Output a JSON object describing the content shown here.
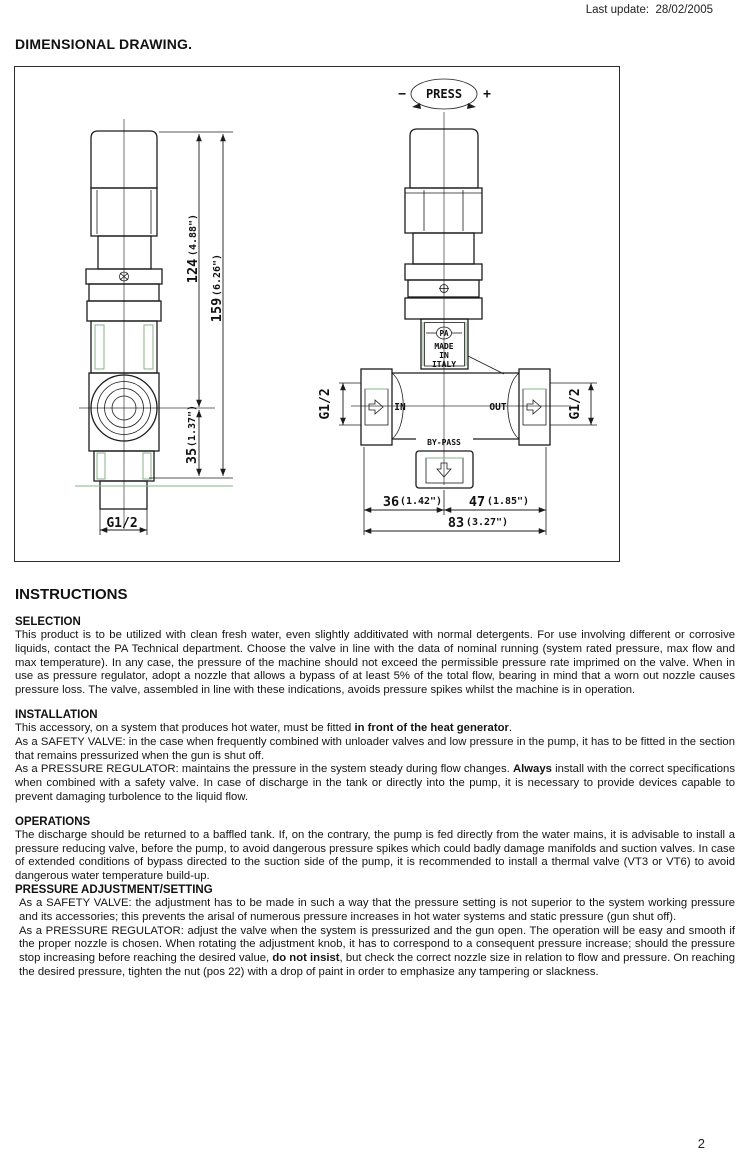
{
  "page": {
    "last_update_label": "Last update:",
    "last_update_value": "28/02/2005",
    "page_number": "2",
    "background_color": "#ffffff",
    "line_color": "#1c1c1c",
    "accent_green": "#8ab38a"
  },
  "drawing": {
    "section_title": "DIMENSIONAL DRAWING.",
    "labels": {
      "press": "PRESS",
      "minus": "−",
      "plus": "+",
      "pa": "PA",
      "made": "MADE",
      "in_country": "IN",
      "italy": "ITALY",
      "inlet": "IN",
      "outlet": "OUT",
      "bypass": "BY-PASS",
      "g12_bottom": "G1/2",
      "g12_inlet": "G1/2",
      "g12_outlet": "G1/2"
    },
    "dimensions": {
      "height_upper_mm": "124",
      "height_upper_in": "(4.88\")",
      "height_total_mm": "159",
      "height_total_in": "(6.26\")",
      "height_lower_mm": "35",
      "height_lower_in": "(1.37\")",
      "width_left_mm": "36",
      "width_left_in": "(1.42\")",
      "width_right_mm": "47",
      "width_right_in": "(1.85\")",
      "width_total_mm": "83",
      "width_total_in": "(3.27\")"
    }
  },
  "instructions": {
    "title": "INSTRUCTIONS",
    "sections": [
      {
        "heading": "SELECTION",
        "paragraphs": [
          {
            "segments": [
              {
                "text": "This product is to be utilized with clean fresh water, even slightly additivated with normal detergents. For use involving different or corrosive liquids, contact the PA Technical department. Choose the valve in line with the data of nominal running (system rated pressure, max flow and max temperature). In any case, the pressure of the machine should not exceed the permissible pressure rate imprimed on the valve.  When in use as pressure regulator, adopt a nozzle that allows a bypass of at least 5% of the total flow, bearing in mind that a worn out nozzle causes pressure loss. The valve, assembled in line with these indications, avoids pressure spikes whilst the machine is in operation.",
                "bold": false
              }
            ]
          }
        ]
      },
      {
        "heading": "INSTALLATION",
        "paragraphs": [
          {
            "segments": [
              {
                "text": "This accessory, on a system that produces hot water, must be fitted ",
                "bold": false
              },
              {
                "text": "in front of the heat generator",
                "bold": true
              },
              {
                "text": ".",
                "bold": false
              }
            ]
          },
          {
            "segments": [
              {
                "text": "As a SAFETY VALVE: in the case when frequently combined with unloader valves and low pressure in the pump, it has to be fitted in the section that remains pressurized when the gun is shut off.",
                "bold": false
              }
            ]
          },
          {
            "segments": [
              {
                "text": "As a PRESSURE REGULATOR: maintains the pressure in the system steady during flow changes. ",
                "bold": false
              },
              {
                "text": "Always",
                "bold": true
              },
              {
                "text": " install with the correct specifications when combined with a safety valve. In case of discharge in the tank or directly into the pump, it is necessary to provide devices capable to prevent damaging turbolence to the liquid flow.",
                "bold": false
              }
            ]
          }
        ]
      },
      {
        "heading": "OPERATIONS",
        "paragraphs": [
          {
            "segments": [
              {
                "text": "The discharge should be returned to a baffled tank. If, on the contrary, the pump is fed directly from the water mains, it is advisable to install a pressure reducing valve, before the pump, to avoid dangerous pressure spikes which could badly damage manifolds and suction valves. In case of extended conditions of bypass directed to the suction side of the pump, it is recommended to install a thermal valve (VT3 or VT6) to avoid dangerous water temperature build-up.",
                "bold": false
              }
            ]
          }
        ]
      },
      {
        "heading": "PRESSURE ADJUSTMENT/SETTING",
        "paragraphs": [
          {
            "segments": [
              {
                "text": "As a SAFETY VALVE: the adjustment has to be made in such a way that the pressure setting is not superior to the system working pressure and its accessories; this prevents the arisal of numerous pressure increases in hot water systems and static pressure (gun shut off).",
                "bold": false
              }
            ]
          },
          {
            "segments": [
              {
                "text": "As a PRESSURE REGULATOR: adjust the valve when the system is pressurized and the gun open. The operation will be easy and smooth if the proper nozzle is chosen. When rotating the adjustment knob, it has to correspond to a consequent pressure increase; should the pressure stop increasing before reaching the desired value, ",
                "bold": false
              },
              {
                "text": "do not insist",
                "bold": true
              },
              {
                "text": ", but check the correct nozzle size in relation to flow and pressure. On reaching the desired pressure, tighten the nut (pos 22) with a drop of paint in order to emphasize any tampering or slackness.",
                "bold": false
              }
            ]
          }
        ]
      }
    ]
  }
}
